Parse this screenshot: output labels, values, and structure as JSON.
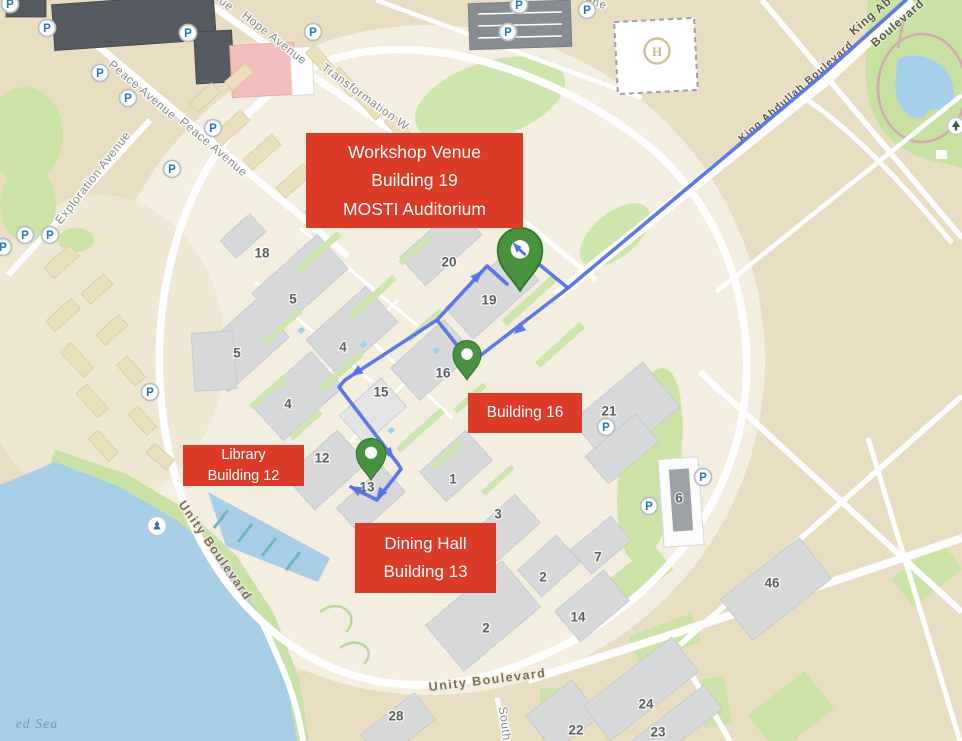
{
  "annotations": {
    "workshop": {
      "lines": [
        "Workshop Venue",
        "Building 19",
        "MOSTI Auditorium"
      ]
    },
    "building16": {
      "lines": [
        "Building 16"
      ]
    },
    "library": {
      "lines": [
        "Library",
        "Building 12"
      ]
    },
    "dining": {
      "lines": [
        "Dining Hall",
        "Building 13"
      ]
    }
  },
  "streets": [
    {
      "id": "hope-avenue",
      "label": "Hope Avenue",
      "x": 272,
      "y": 41,
      "rot": 38,
      "cls": "avenue"
    },
    {
      "id": "hope-avenue-partial",
      "label": "ue",
      "x": 224,
      "y": 7,
      "rot": 38,
      "cls": "avenue"
    },
    {
      "id": "lane-partial",
      "label": "ane",
      "x": 595,
      "y": 6,
      "rot": 18,
      "cls": "avenue"
    },
    {
      "id": "peace-avenue-1",
      "label": "Peace Avenue",
      "x": 140,
      "y": 93,
      "rot": 40,
      "cls": "avenue"
    },
    {
      "id": "peace-avenue-2",
      "label": "Peace Avenue",
      "x": 211,
      "y": 150,
      "rot": 40,
      "cls": "avenue"
    },
    {
      "id": "exploration-avenue",
      "label": "Exploration Avenue",
      "x": 96,
      "y": 180,
      "rot": -52,
      "cls": "avenue"
    },
    {
      "id": "transformation-way",
      "label": "Transformation W",
      "x": 363,
      "y": 100,
      "rot": 36,
      "cls": "avenue"
    },
    {
      "id": "king-abdullah-boulevard",
      "label": "King Abdullah Boulevard",
      "x": 798,
      "y": 94,
      "rot": -41,
      "cls": "blvd-sm"
    },
    {
      "id": "king-abdullah-corner",
      "label": "King Ab",
      "x": 873,
      "y": 19,
      "rot": -41,
      "cls": "blvd-dark"
    },
    {
      "id": "boulevard-corner",
      "label": "Boulevard",
      "x": 900,
      "y": 26,
      "rot": -41,
      "cls": "blvd-dark"
    },
    {
      "id": "unity-boulevard-coast",
      "label": "Unity Boulevard",
      "x": 212,
      "y": 553,
      "rot": 55,
      "cls": "blvd"
    },
    {
      "id": "unity-boulevard-bottom",
      "label": "Unity Boulevard",
      "x": 488,
      "y": 684,
      "rot": -7,
      "cls": "blvd"
    },
    {
      "id": "south-street",
      "label": "South",
      "x": 501,
      "y": 724,
      "rot": 83,
      "cls": "avenue"
    },
    {
      "id": "red-sea",
      "label": "ed Sea",
      "x": 37,
      "y": 728,
      "rot": 0,
      "cls": "water-label"
    }
  ],
  "building_numbers": [
    {
      "label": "18",
      "x": 262,
      "y": 253
    },
    {
      "label": "5",
      "x": 293,
      "y": 299
    },
    {
      "label": "5",
      "x": 237,
      "y": 353
    },
    {
      "label": "4",
      "x": 343,
      "y": 347
    },
    {
      "label": "4",
      "x": 288,
      "y": 404
    },
    {
      "label": "20",
      "x": 449,
      "y": 262
    },
    {
      "label": "19",
      "x": 489,
      "y": 300
    },
    {
      "label": "16",
      "x": 443,
      "y": 373
    },
    {
      "label": "15",
      "x": 381,
      "y": 392
    },
    {
      "label": "12",
      "x": 322,
      "y": 458
    },
    {
      "label": "13",
      "x": 367,
      "y": 487
    },
    {
      "label": "1",
      "x": 453,
      "y": 479
    },
    {
      "label": "3",
      "x": 498,
      "y": 514
    },
    {
      "label": "2",
      "x": 543,
      "y": 577
    },
    {
      "label": "2",
      "x": 486,
      "y": 628
    },
    {
      "label": "7",
      "x": 598,
      "y": 557
    },
    {
      "label": "6",
      "x": 679,
      "y": 498
    },
    {
      "label": "21",
      "x": 609,
      "y": 411
    },
    {
      "label": "46",
      "x": 772,
      "y": 583
    },
    {
      "label": "14",
      "x": 578,
      "y": 617
    },
    {
      "label": "28",
      "x": 396,
      "y": 716
    },
    {
      "label": "22",
      "x": 576,
      "y": 730
    },
    {
      "label": "24",
      "x": 646,
      "y": 704
    },
    {
      "label": "23",
      "x": 658,
      "y": 732
    }
  ],
  "parking_icons": [
    [
      10,
      4
    ],
    [
      47,
      28
    ],
    [
      188,
      33
    ],
    [
      313,
      32
    ],
    [
      519,
      5
    ],
    [
      508,
      32
    ],
    [
      587,
      10
    ],
    [
      100,
      73
    ],
    [
      128,
      98
    ],
    [
      213,
      128
    ],
    [
      172,
      169
    ],
    [
      25,
      235
    ],
    [
      50,
      235
    ],
    [
      3,
      247
    ],
    [
      150,
      392
    ],
    [
      606,
      427
    ],
    [
      703,
      477
    ],
    [
      649,
      506
    ]
  ],
  "poi": {
    "helipad_letter": "H"
  },
  "route": {
    "color": "#5472e8",
    "paths": [
      {
        "id": "boulevard-approach",
        "points": [
          [
            906,
            0
          ],
          [
            820,
            77
          ],
          [
            568,
            288
          ],
          [
            472,
            362
          ]
        ]
      },
      {
        "id": "spur-building19",
        "points": [
          [
            568,
            288
          ],
          [
            524,
            252
          ]
        ]
      },
      {
        "id": "leg-16-to-19",
        "points": [
          [
            460,
            349
          ],
          [
            437,
            320
          ],
          [
            487,
            266
          ],
          [
            507,
            284
          ]
        ]
      },
      {
        "id": "leg-16-to-13",
        "points": [
          [
            437,
            320
          ],
          [
            345,
            380
          ],
          [
            339,
            387
          ],
          [
            398,
            464
          ],
          [
            401,
            469
          ],
          [
            377,
            500
          ],
          [
            351,
            487
          ]
        ]
      }
    ],
    "arrows": [
      {
        "x": 515,
        "y": 333,
        "angle": 140
      },
      {
        "x": 524,
        "y": 252,
        "angle": 219
      },
      {
        "x": 481,
        "y": 272,
        "angle": -47
      },
      {
        "x": 352,
        "y": 375,
        "angle": 147
      },
      {
        "x": 393,
        "y": 458,
        "angle": 52
      },
      {
        "x": 377,
        "y": 498,
        "angle": 128
      },
      {
        "x": 351,
        "y": 487,
        "angle": 207
      }
    ]
  },
  "pins": [
    {
      "id": "workshop-venue-pin",
      "tip_x": 520,
      "tip_y": 291,
      "scale": 1.6,
      "glyph": "arrow"
    },
    {
      "id": "building-16-pin",
      "tip_x": 467,
      "tip_y": 380,
      "scale": 1.0,
      "glyph": ""
    },
    {
      "id": "building-13-pin",
      "tip_x": 371,
      "tip_y": 480,
      "scale": 1.05,
      "glyph": ""
    }
  ],
  "colors": {
    "land": "#e9ddc2",
    "campus": "#f3eee0",
    "water": "#a8cde7",
    "green": "#cbe3a6",
    "building_gray": "#d6d8da",
    "label_red": "#db3b27",
    "pin_green": "#47913f",
    "route_blue": "#5472e8",
    "parking_blue": "#2579b8"
  }
}
